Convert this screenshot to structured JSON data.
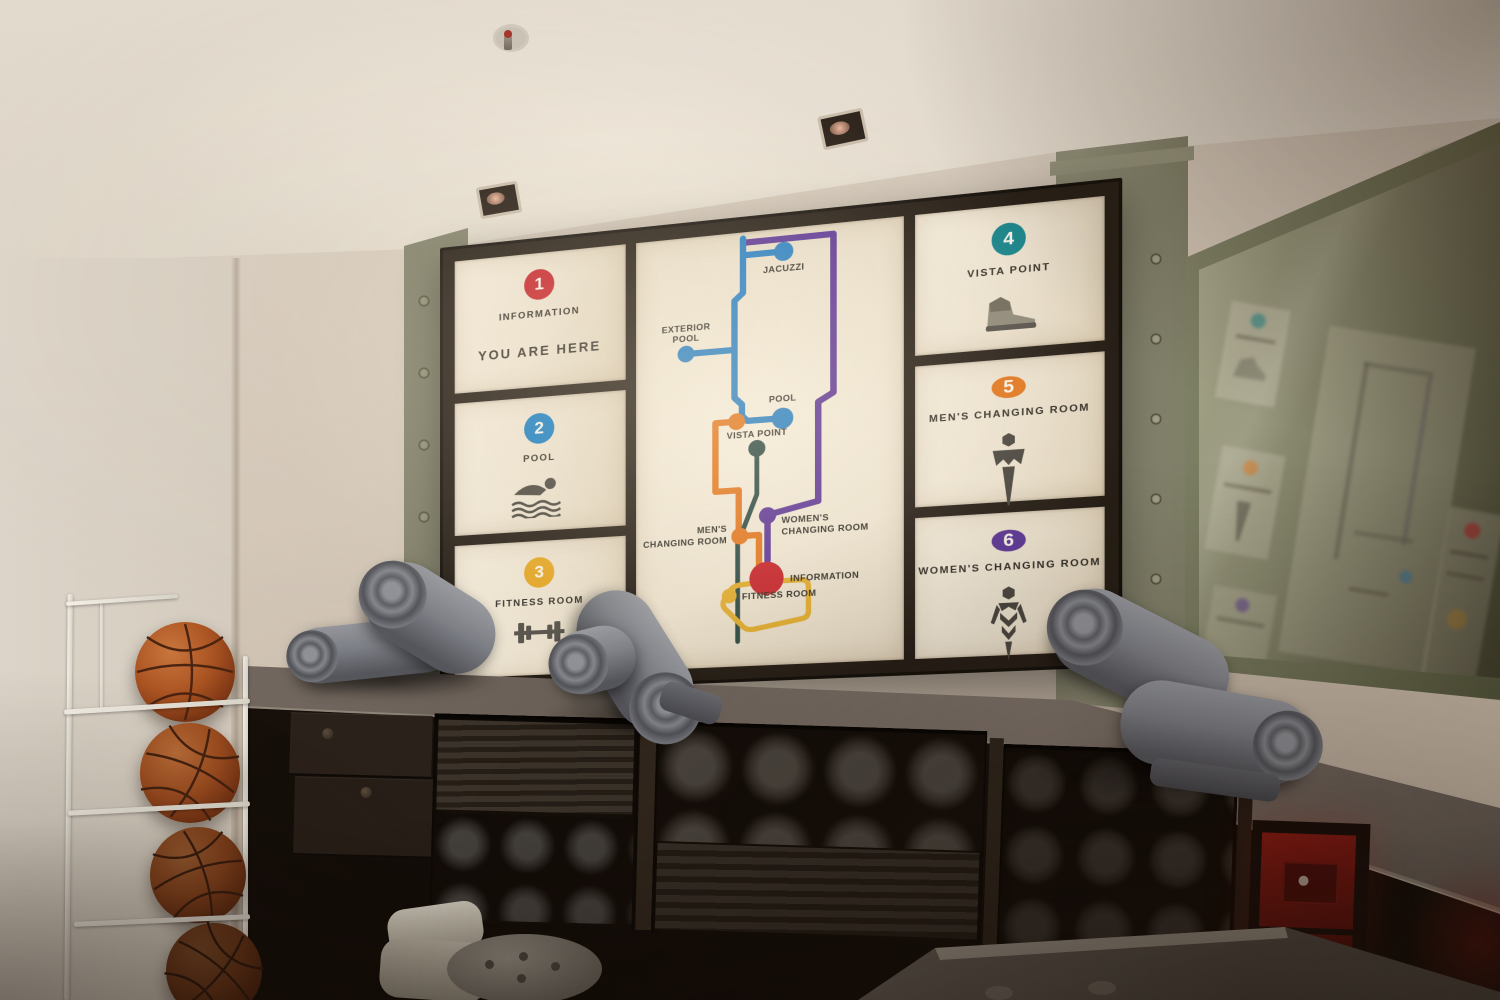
{
  "signboard": {
    "panels_left": [
      {
        "number": "1",
        "badge_color": "#c4242b",
        "label": "INFORMATION",
        "sublabel": "YOU ARE HERE"
      },
      {
        "number": "2",
        "badge_color": "#1a7dc0",
        "label": "POOL"
      },
      {
        "number": "3",
        "badge_color": "#e2a424",
        "label": "FITNESS ROOM"
      }
    ],
    "panels_right": [
      {
        "number": "4",
        "badge_color": "#17838a",
        "label": "VISTA POINT"
      },
      {
        "number": "5",
        "badge_color": "#e0761f",
        "label": "MEN'S CHANGING ROOM"
      },
      {
        "number": "6",
        "badge_color": "#5c3794",
        "label": "WOMEN'S CHANGING ROOM"
      }
    ],
    "map": {
      "labels": {
        "jacuzzi": "JACUZZI",
        "exterior_pool_line1": "EXTERIOR",
        "exterior_pool_line2": "POOL",
        "pool": "POOL",
        "vista_point": "VISTA POINT",
        "mens_line1": "MEN'S",
        "mens_line2": "CHANGING ROOM",
        "womens_line1": "WOMEN'S",
        "womens_line2": "CHANGING ROOM",
        "information": "INFORMATION",
        "fitness_room": "FITNESS ROOM"
      },
      "line_colors": {
        "blue": "#2a7fc1",
        "purple": "#5d3795",
        "orange": "#e0761f",
        "teal": "#2e4a44",
        "yellow": "#dfaa2e",
        "red": "#c4242b"
      }
    }
  },
  "room": {
    "basketball_count": 4,
    "towel_rolls_on_counter": 5
  }
}
